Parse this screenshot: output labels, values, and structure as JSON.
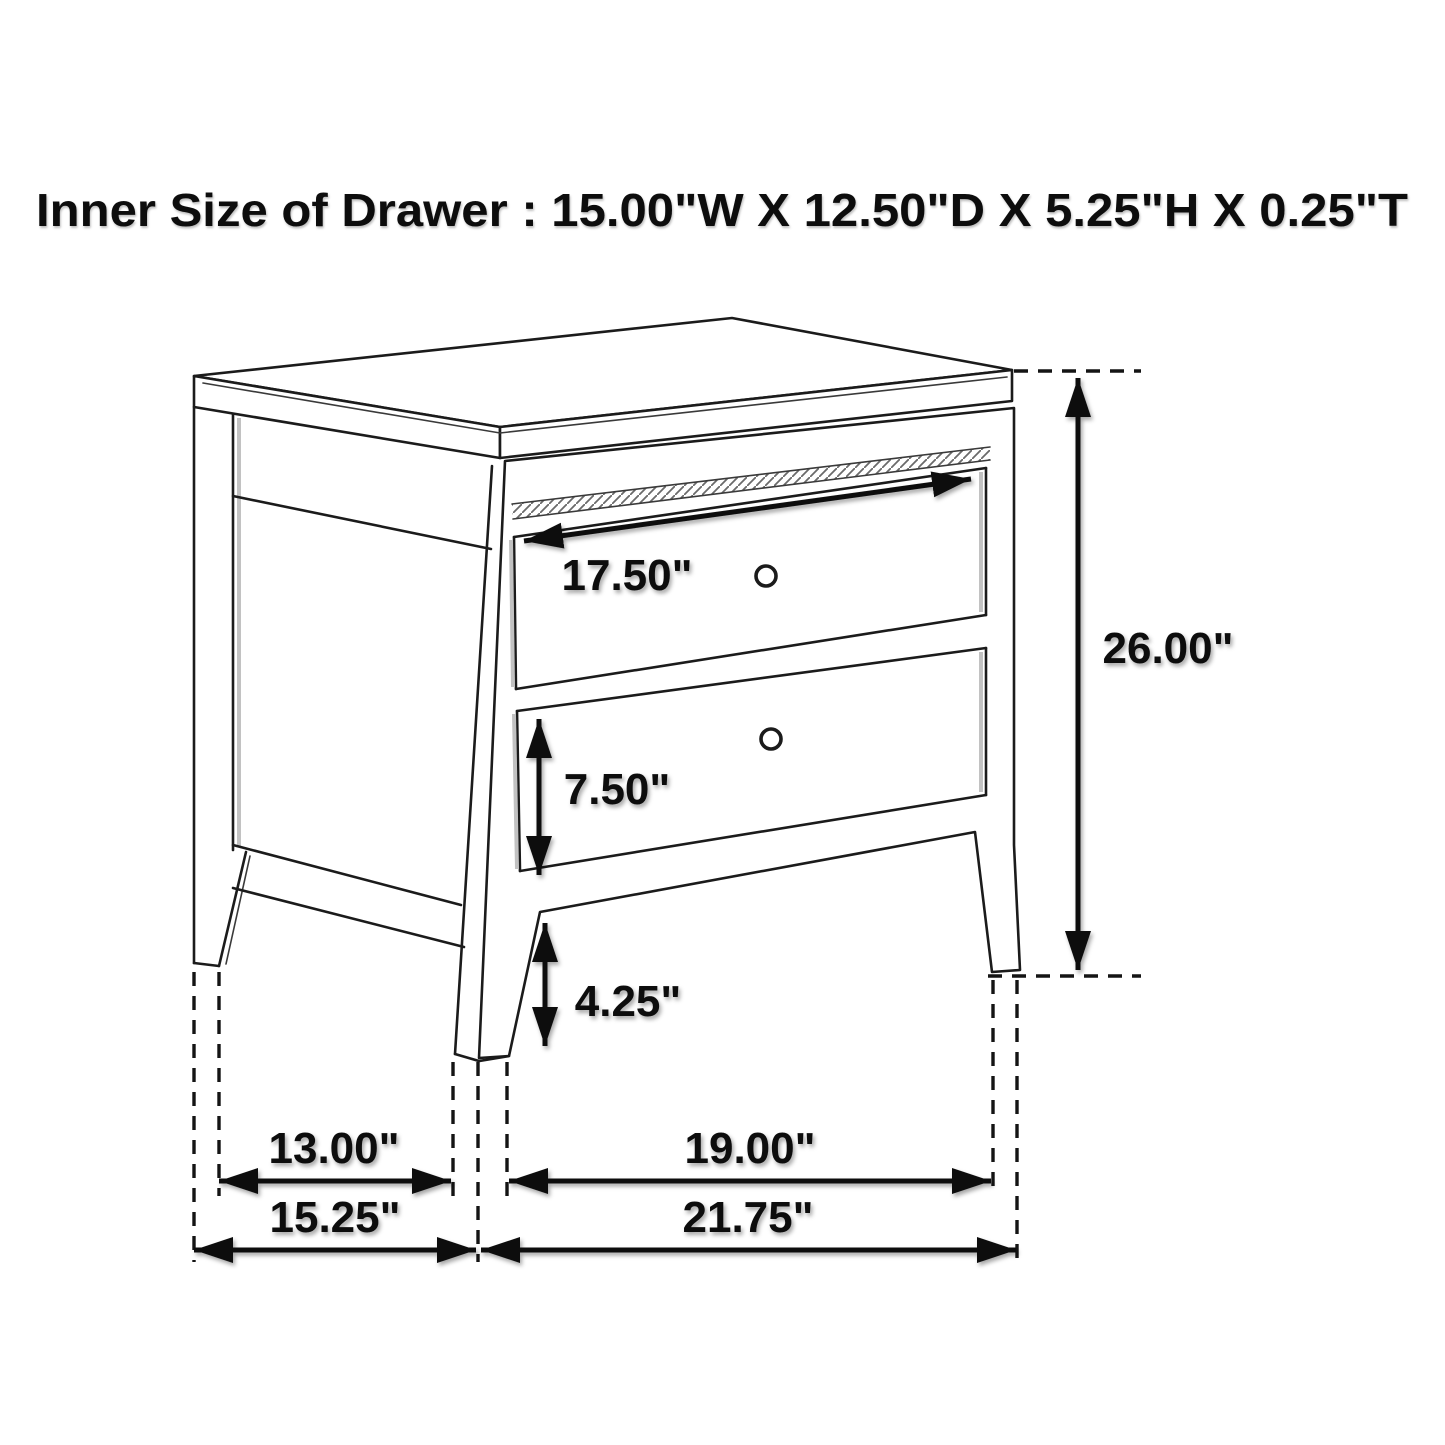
{
  "page": {
    "background_color": "#ffffff",
    "ink_color": "#1b1b1b"
  },
  "title": {
    "text": "Inner Size of Drawer : 15.00\"W X 12.50\"D X 5.25\"H X 0.25\"T"
  },
  "diagram": {
    "subject": "two-drawer nightstand",
    "style": "black-and-white perspective dimension line drawing",
    "knob_count": 2,
    "dimensions": [
      {
        "id": "top-drawer-width",
        "label": "17.50\""
      },
      {
        "id": "overall-height",
        "label": "26.00\""
      },
      {
        "id": "bottom-drawer-height",
        "label": "7.50\""
      },
      {
        "id": "bottom-clearance",
        "label": "4.25\""
      },
      {
        "id": "side-leg-spacing",
        "label": "13.00\""
      },
      {
        "id": "front-leg-spacing",
        "label": "19.00\""
      },
      {
        "id": "overall-depth",
        "label": "15.25\""
      },
      {
        "id": "overall-width",
        "label": "21.75\""
      }
    ]
  }
}
